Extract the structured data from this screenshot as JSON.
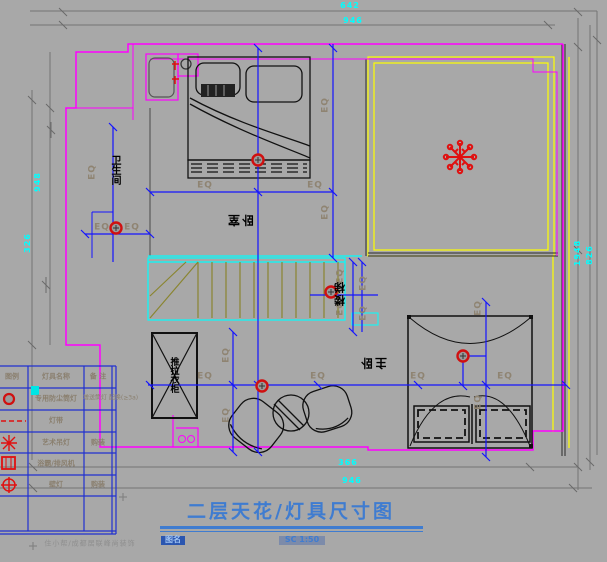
{
  "title": {
    "text": "二层天花/灯具尺寸图",
    "name_label": "图名",
    "scale": "SC 1:50"
  },
  "watermark": "住小帮/成都居联峰尚装饰",
  "labels": {
    "eq": "EQ"
  },
  "rooms": {
    "bedroom": "卧室",
    "stairs": "楼梯",
    "master_bedroom": "主卧",
    "bathroom": "卫生间",
    "wardrobe": "推拉衣柜"
  },
  "dimensions": {
    "top": [
      "642",
      "946"
    ],
    "bottom": [
      "366",
      "946"
    ],
    "left": [
      "948",
      "326"
    ],
    "right": [
      "1948",
      "826"
    ]
  },
  "legend": {
    "headers": [
      "图例",
      "灯具名称",
      "备 注"
    ],
    "rows": [
      {
        "symbol": "downlight-icon",
        "name": "专用防尘筒灯",
        "remark": "增送筒灯 配换(≥3a)"
      },
      {
        "symbol": "light-strip-icon",
        "name": "灯带",
        "remark": ""
      },
      {
        "symbol": "chandelier-icon",
        "name": "艺术吊灯",
        "remark": "购装"
      },
      {
        "symbol": "exhaust-fan-icon",
        "name": "浴霸/排风机",
        "remark": ""
      },
      {
        "symbol": "wall-lamp-icon",
        "name": "壁灯",
        "remark": "购装"
      }
    ]
  },
  "colors": {
    "wall_magenta": "#ff00ff",
    "dim_blue": "#1414ff",
    "stair_cyan": "#00ffff",
    "cove_yellow": "#ffff00",
    "symbol_red": "#e01010",
    "title_blue": "#3f7cd0"
  }
}
